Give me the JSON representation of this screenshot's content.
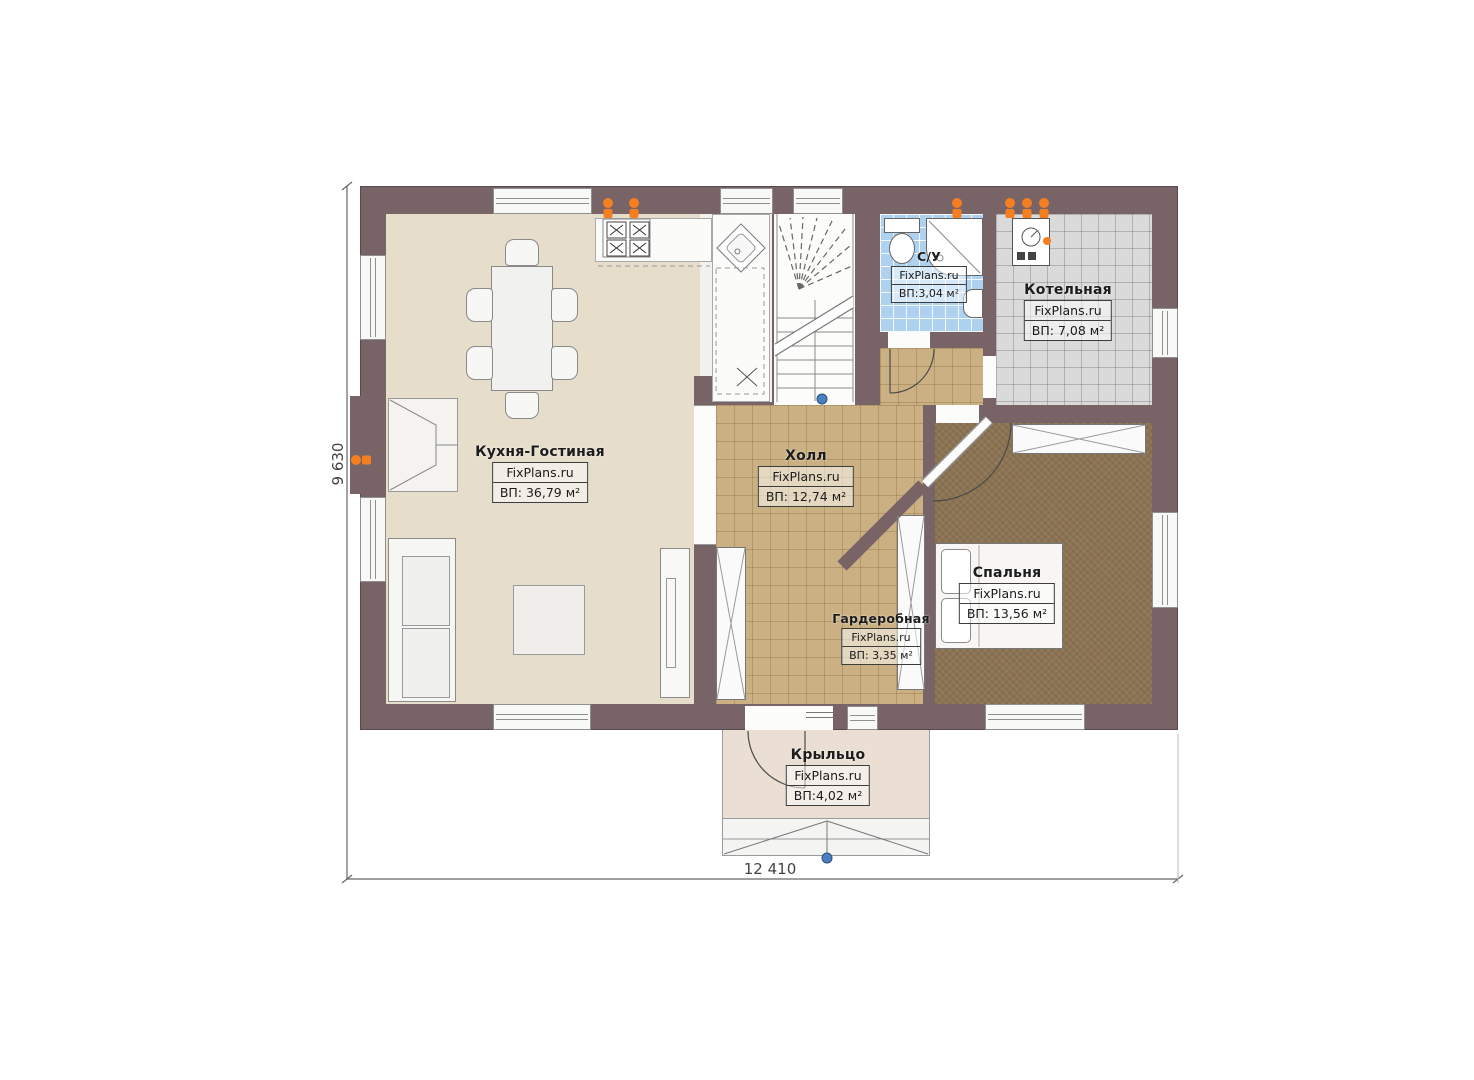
{
  "plan": {
    "width_dim": "12 410",
    "height_dim": "9 630"
  },
  "rooms": {
    "kitchen": {
      "name": "Кухня-Гостиная",
      "brand": "FixPlans.ru",
      "area": "ВП: 36,79 м²"
    },
    "hall": {
      "name": "Холл",
      "brand": "FixPlans.ru",
      "area": "ВП: 12,74 м²"
    },
    "bathroom": {
      "name": "С/У",
      "brand": "FixPlans.ru",
      "area": "ВП:3,04 м²"
    },
    "boiler": {
      "name": "Котельная",
      "brand": "FixPlans.ru",
      "area": "ВП: 7,08 м²"
    },
    "bedroom": {
      "name": "Спальня",
      "brand": "FixPlans.ru",
      "area": "ВП: 13,56 м²"
    },
    "wardrobe": {
      "name": "Гардеробная",
      "brand": "FixPlans.ru",
      "area": "ВП: 3,35 м²"
    },
    "porch": {
      "name": "Крыльцо",
      "brand": "FixPlans.ru",
      "area": "ВП:4,02 м²"
    }
  },
  "colors": {
    "wall": "#786467",
    "kitchen_floor": "#e7ddcb",
    "hall_floor": "#cbb083",
    "bedroom_floor": "#8c7453",
    "bathroom_floor": "#aed1f0",
    "boiler_floor": "#dadada",
    "porch_floor": "#eadfd2",
    "radiator": "#f57e20",
    "marker_blue": "#4a7fc1"
  }
}
